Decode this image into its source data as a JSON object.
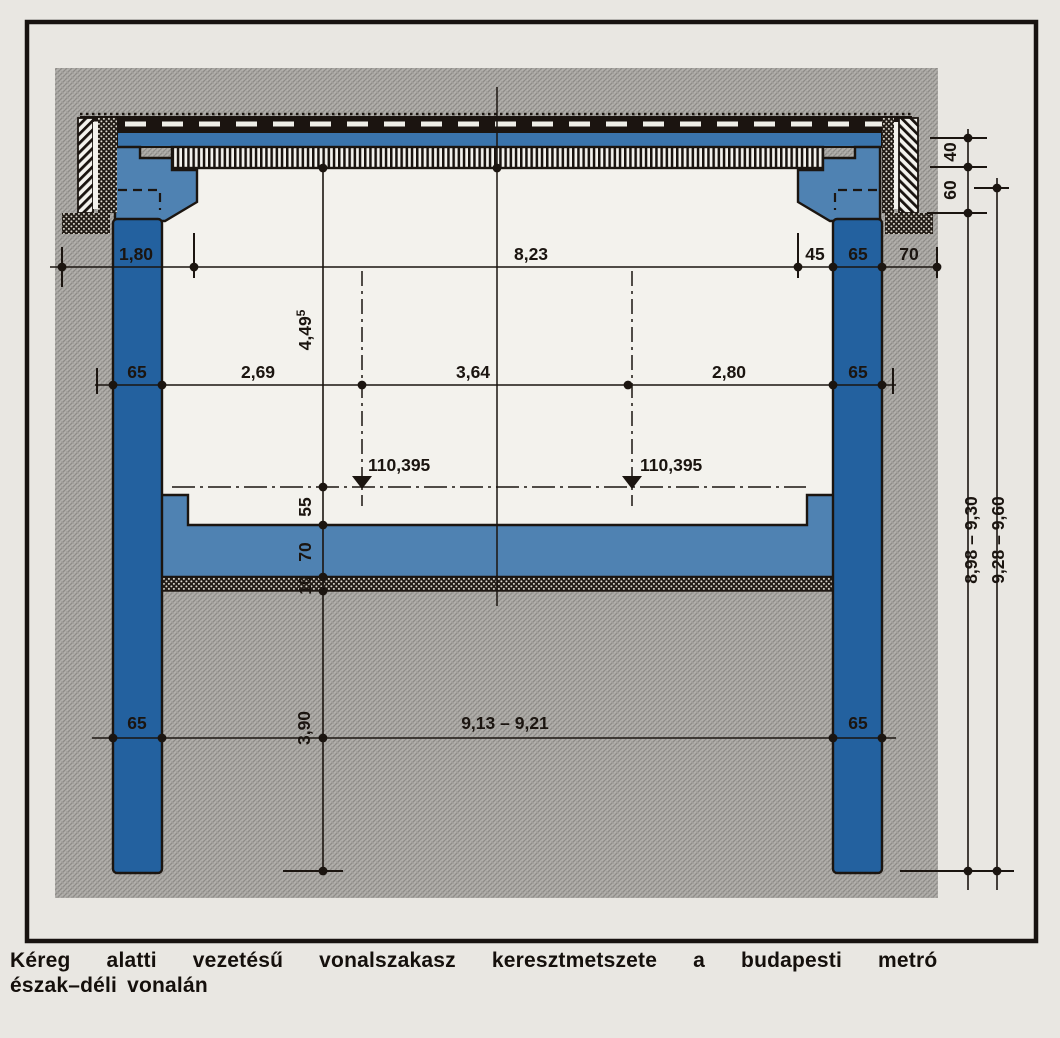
{
  "figure": {
    "caption_line1": "Kéreg alatti vezetésű vonalszakasz keresztmetszete a budapesti metró",
    "caption_line2": "észak–déli vonalán"
  },
  "dims": {
    "top": {
      "left_offset": "1,80",
      "clear_span": "8,23",
      "ledge": "45",
      "wall": "65",
      "outer": "70"
    },
    "mid": {
      "wall_left": "65",
      "left_track": "2,69",
      "track_gap": "3,64",
      "right_track": "2,80",
      "wall_right": "65"
    },
    "bottom": {
      "pile_left": "65",
      "pile_span": "9,13 – 9,21",
      "pile_right": "65"
    },
    "chain": {
      "clear_height": "4,49",
      "clear_height_sup": "5",
      "rail_to_slab": "55",
      "slab": "70",
      "blinding": "10",
      "pile_depth": "3,90"
    },
    "levels": {
      "left_rail": "110,395",
      "right_rail": "110,395"
    },
    "right": {
      "pavement": "40",
      "cover": "60",
      "depth_inner": "8,98 – 9,30",
      "depth_outer": "9,28 – 9,60"
    }
  },
  "colors": {
    "wall_blue": "#23619f",
    "slab_blue": "#4f82b2",
    "roof_blue": "#3a74ac",
    "line": "#1b1510",
    "paper": "#e9e7e2",
    "interior": "#f3f2ed",
    "ground_gray": "#a7a5a1"
  }
}
